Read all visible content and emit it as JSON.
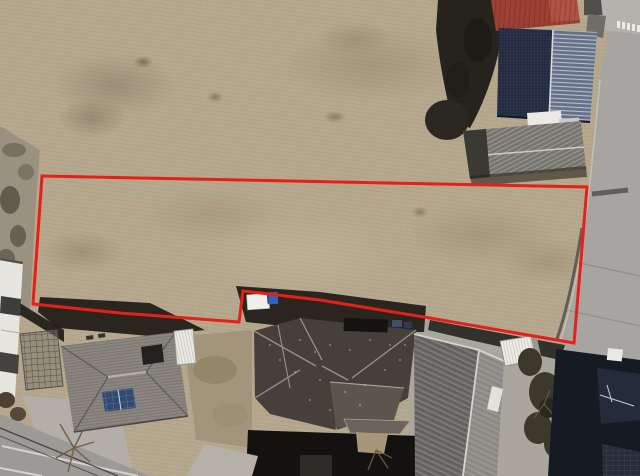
{
  "scene": {
    "description": "Aerial drone photograph of a long vacant dry-grass land parcel outlined with a red boundary line, surrounded by residential houses, sheds and roads",
    "type": "aerial-photo",
    "width": 640,
    "height": 476
  },
  "boundary": {
    "color": "#e62019",
    "stroke_width": 3,
    "closed": true,
    "points": [
      [
        42,
        176
      ],
      [
        587,
        187
      ],
      [
        574,
        343
      ],
      [
        430,
        318
      ],
      [
        320,
        300
      ],
      [
        243,
        291
      ],
      [
        239,
        322
      ],
      [
        120,
        313
      ],
      [
        33,
        304
      ]
    ]
  },
  "palette": {
    "field": "#b5a78c",
    "dirt": "#a2957b",
    "road": "#a7a5a1",
    "concrete": "#aaa69e",
    "shadow": "#1f1c17",
    "tree": "#3c382b",
    "red_roof": "#9d4034",
    "navy_roof": "#232b42",
    "steel_roof_light": "#64718a",
    "gray_shed": "#77756f",
    "left_roof": "#8b8680",
    "center_roof": "#46403a",
    "right_roof": "#6b6965",
    "dark_roof": "#161a23",
    "solar_panel": "#314970",
    "truck_white": "#f0efec",
    "truck_blue": "#2f63b5",
    "white_building": "#e7e5e0"
  },
  "objects": [
    "vacant-field-parcel",
    "red-boundary-outline",
    "left-rocky-strip",
    "white-apartment-building",
    "pergola-frame",
    "left-house-gray-roof-with-solar-panels",
    "center-house-dark-hip-roof",
    "right-house-ribbed-roof",
    "far-right-dark-roof-house",
    "red-roof-building",
    "navy-metal-roof-building",
    "gray-metal-shed",
    "white-shed",
    "white-truck",
    "right-side-road",
    "bottom-left-road",
    "trees-and-shrubs"
  ]
}
